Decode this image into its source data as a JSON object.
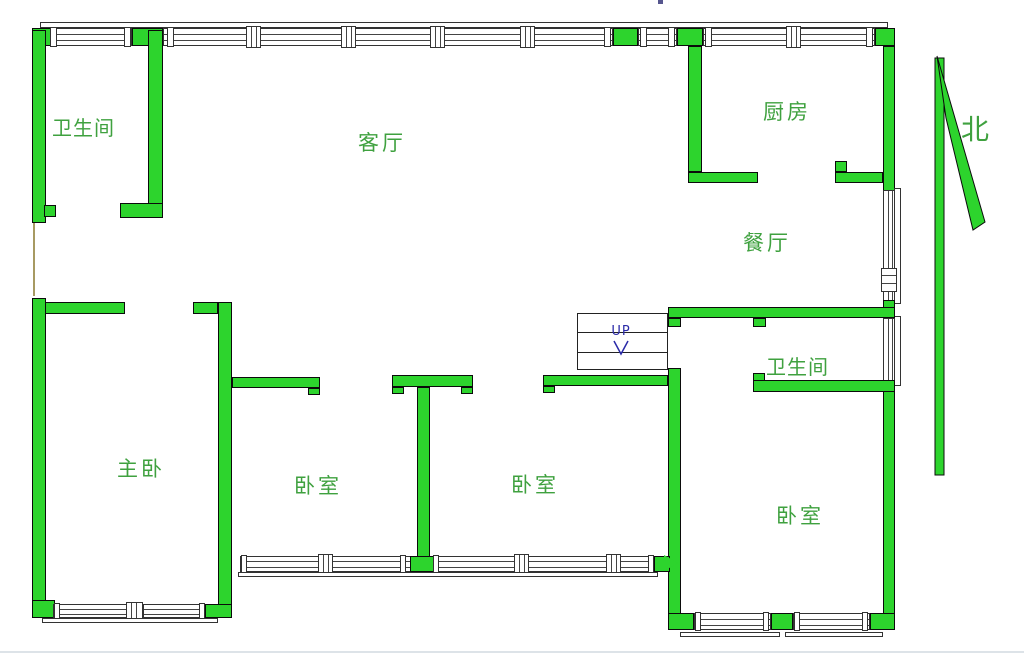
{
  "plan_title": "residential-floor-plan",
  "rooms": [
    {
      "id": "bathroom-top-left",
      "label": "卫生间"
    },
    {
      "id": "living-room",
      "label": "客厅"
    },
    {
      "id": "kitchen",
      "label": "厨房"
    },
    {
      "id": "dining-room",
      "label": "餐厅"
    },
    {
      "id": "bathroom-right",
      "label": "卫生间"
    },
    {
      "id": "master-bedroom",
      "label": "主卧"
    },
    {
      "id": "bedroom-1",
      "label": "卧室"
    },
    {
      "id": "bedroom-2",
      "label": "卧室"
    },
    {
      "id": "bedroom-3",
      "label": "卧室"
    }
  ],
  "compass": {
    "label": "北"
  },
  "stairs": {
    "label": "UP"
  },
  "colors": {
    "wall": "#2dd42d",
    "wall_outline": "#0b0b0b",
    "room_label_text": "#3fa13f",
    "stair_text": "#2a2aa8",
    "window_line": "#444444"
  }
}
